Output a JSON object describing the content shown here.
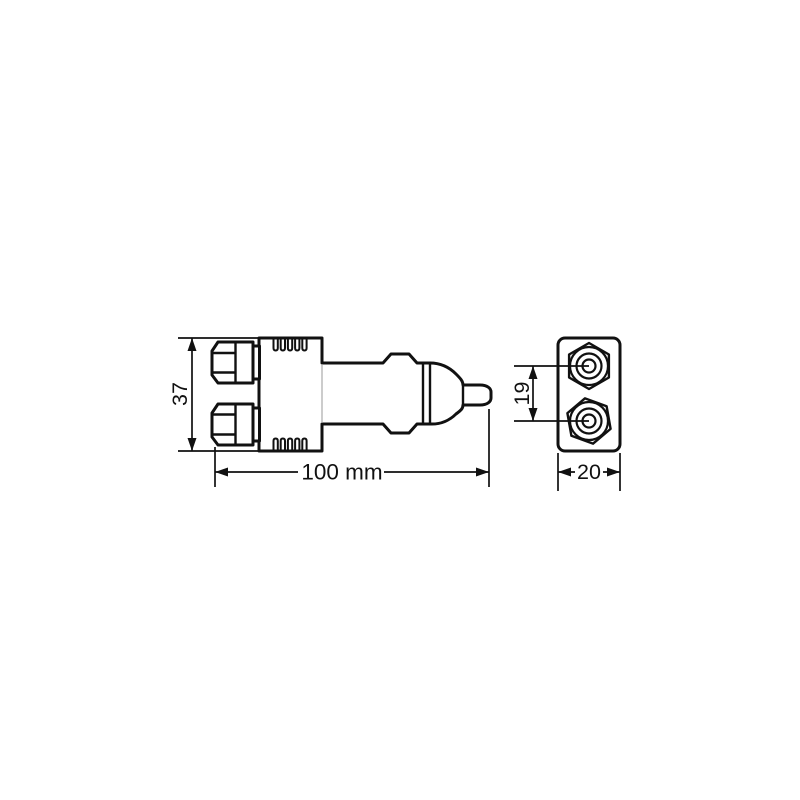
{
  "drawing": {
    "background": "#ffffff",
    "line_color": "#111111",
    "side_view": {
      "height_dim": {
        "label": "37"
      },
      "length_dim": {
        "label": "100 mm"
      }
    },
    "front_view": {
      "spacing_dim": {
        "label": "19"
      },
      "width_dim": {
        "label": "20"
      }
    }
  }
}
